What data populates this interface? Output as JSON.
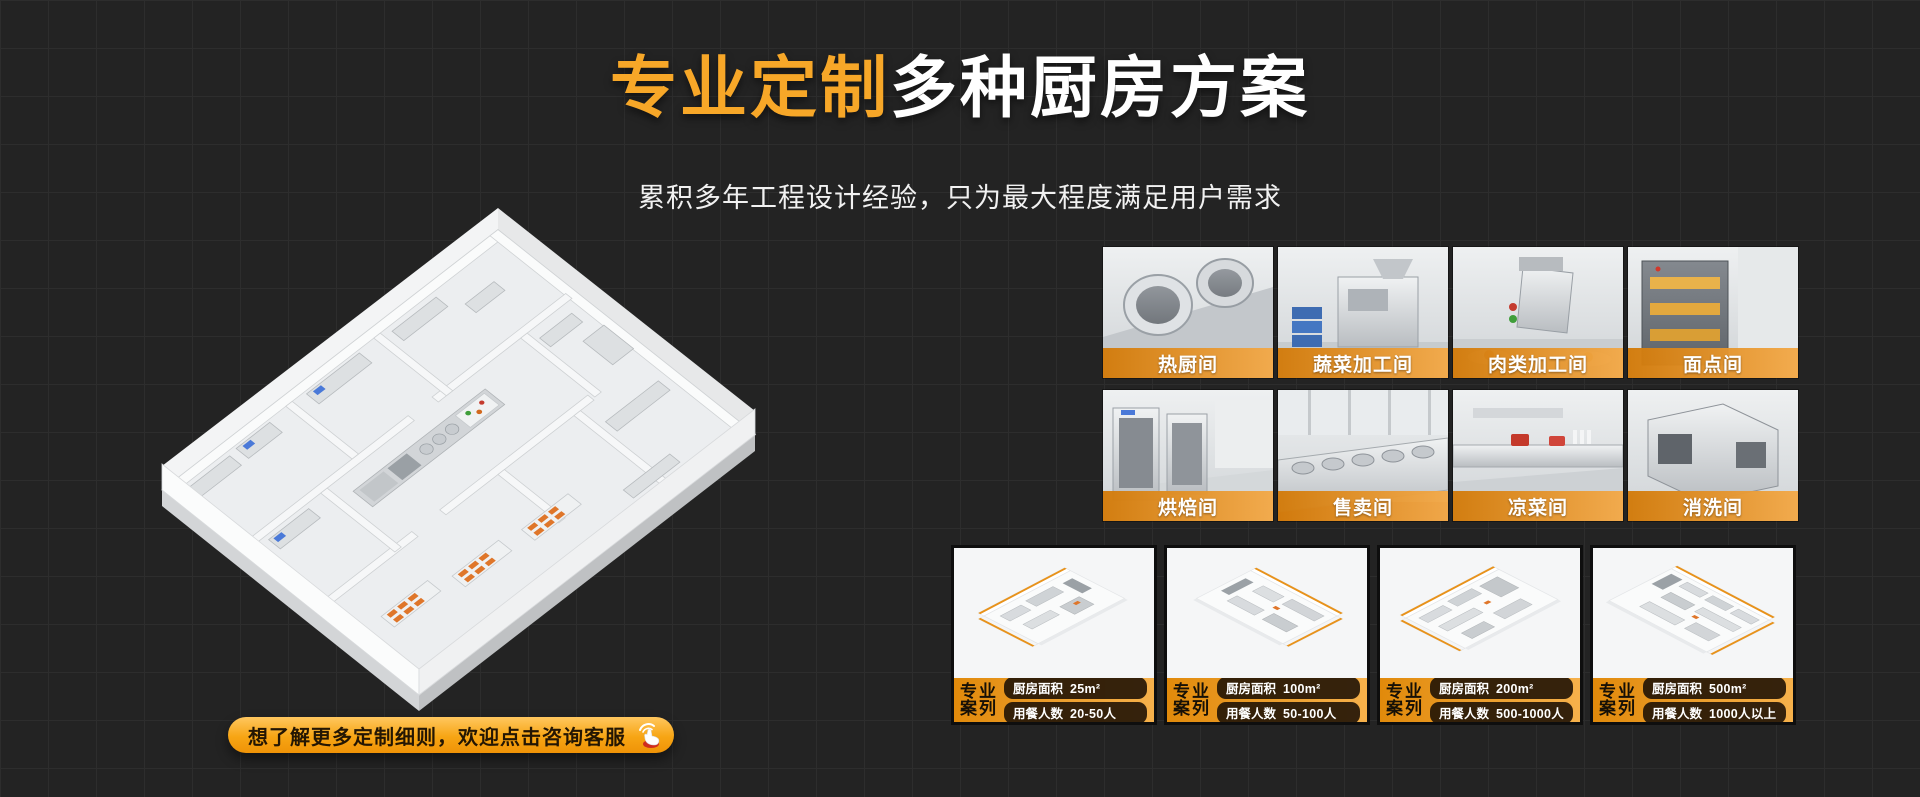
{
  "header": {
    "title_highlight": "专业定制",
    "title_rest": "多种厨房方案",
    "subtitle": "累积多年工程设计经验，只为最大程度满足用户需求"
  },
  "colors": {
    "background": "#232323",
    "grid_line": "#2d2d2d",
    "accent_orange": "#f7a728",
    "label_gradient_start": "#d27a09",
    "label_gradient_end": "#f3a948",
    "case_pill_bg": "#201305"
  },
  "floorplan": {
    "description": "isometric-3d-kitchen-floorplan-illustration"
  },
  "rooms": [
    {
      "label": "热厨间"
    },
    {
      "label": "蔬菜加工间"
    },
    {
      "label": "肉类加工间"
    },
    {
      "label": "面点间"
    },
    {
      "label": "烘焙间"
    },
    {
      "label": "售卖间"
    },
    {
      "label": "凉菜间"
    },
    {
      "label": "消洗间"
    }
  ],
  "cases": [
    {
      "tag_line1": "专业",
      "tag_line2": "案列",
      "area_label": "厨房面积",
      "area_value": "25m²",
      "diners_label": "用餐人数",
      "diners_value": "20-50人"
    },
    {
      "tag_line1": "专业",
      "tag_line2": "案列",
      "area_label": "厨房面积",
      "area_value": "100m²",
      "diners_label": "用餐人数",
      "diners_value": "50-100人"
    },
    {
      "tag_line1": "专业",
      "tag_line2": "案列",
      "area_label": "厨房面积",
      "area_value": "200m²",
      "diners_label": "用餐人数",
      "diners_value": "500-1000人"
    },
    {
      "tag_line1": "专业",
      "tag_line2": "案列",
      "area_label": "厨房面积",
      "area_value": "500m²",
      "diners_label": "用餐人数",
      "diners_value": "1000人以上"
    }
  ],
  "cta": {
    "label": "想了解更多定制细则，欢迎点击咨询客服"
  }
}
